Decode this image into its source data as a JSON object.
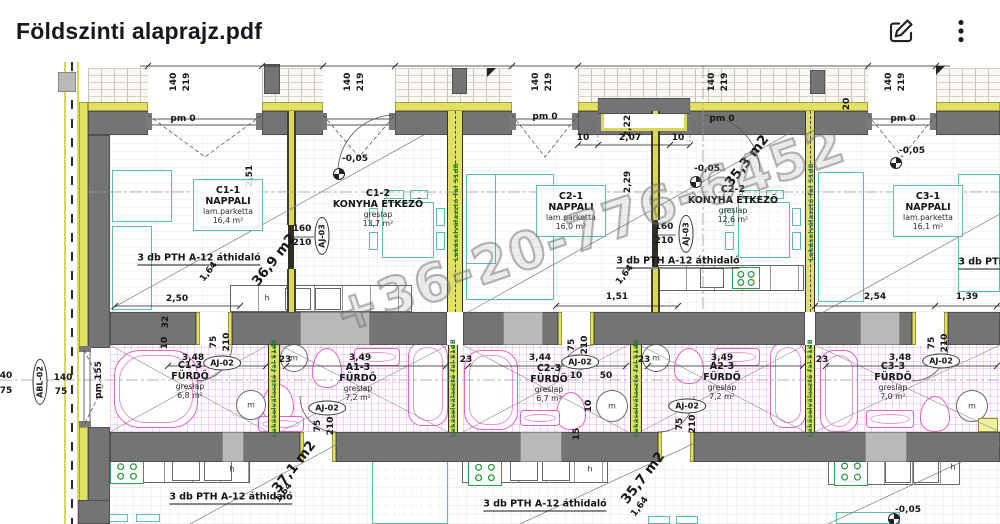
{
  "header": {
    "title": "Földszinti alaprajz.pdf"
  },
  "plan": {
    "watermark": "+36-20-776-6452",
    "separator_wall_label": "Lakáselválasztó fal 51dB",
    "lintel_label": "3 db PTH A-12 áthidaló",
    "separator_positions": [
      {
        "x": 456,
        "y": 150
      },
      {
        "x": 811,
        "y": 150
      },
      {
        "x": 274,
        "y": 326
      },
      {
        "x": 453,
        "y": 326
      },
      {
        "x": 636,
        "y": 326
      },
      {
        "x": 810,
        "y": 326
      }
    ],
    "lintel_positions": [
      {
        "x": 199,
        "y": 197
      },
      {
        "x": 678,
        "y": 200
      },
      {
        "x": 231,
        "y": 436
      },
      {
        "x": 545,
        "y": 443
      },
      {
        "x": 1020,
        "y": 201
      }
    ],
    "rooms": [
      {
        "id": "C1-1",
        "name": "NAPPALI",
        "floor": "lam.parketta",
        "area": "16,4 m²",
        "x": 228,
        "y": 117,
        "boxed": true
      },
      {
        "id": "C1-2",
        "name": "KONYHA ÉTKEZŐ",
        "floor": "greslap",
        "area": "13,7 m²",
        "x": 378,
        "y": 126
      },
      {
        "id": "C2-1",
        "name": "NAPPALI",
        "floor": "lam.parketta",
        "area": "16,0 m²",
        "x": 571,
        "y": 123,
        "boxed": true
      },
      {
        "id": "C2-2",
        "name": "KONYHA ÉTKEZŐ",
        "floor": "greslap",
        "area": "12,6 m²",
        "x": 733,
        "y": 122
      },
      {
        "id": "C3-1",
        "name": "NAPPALI",
        "floor": "lam.parketta",
        "area": "16,1 m²",
        "x": 928,
        "y": 123,
        "boxed": true
      },
      {
        "id": "C1-3",
        "name": "FÜRDŐ",
        "floor": "greslap",
        "area": "6,8 m²",
        "x": 190,
        "y": 298
      },
      {
        "id": "A1-3",
        "name": "FÜRDŐ",
        "floor": "greslap",
        "area": "7,2 m²",
        "x": 358,
        "y": 300
      },
      {
        "id": "C2-3",
        "name": "FÜRDŐ",
        "floor": "greslap",
        "area": "6,7 m²",
        "x": 549,
        "y": 301
      },
      {
        "id": "A2-3",
        "name": "FÜRDŐ",
        "floor": "greslap",
        "area": "7,2 m²",
        "x": 722,
        "y": 299
      },
      {
        "id": "C3-3",
        "name": "FÜRDŐ",
        "floor": "greslap",
        "area": "7,0 m²",
        "x": 893,
        "y": 299
      }
    ],
    "levels": [
      {
        "x": 338,
        "y": 111
      },
      {
        "x": 695,
        "y": 119
      },
      {
        "x": 895,
        "y": 100
      },
      {
        "x": 893,
        "y": 456
      }
    ],
    "annotations": [
      {
        "t": "140",
        "x": 174,
        "y": 20,
        "r": -90
      },
      {
        "t": "219",
        "x": 187,
        "y": 20,
        "r": -90
      },
      {
        "t": "140",
        "x": 348,
        "y": 20,
        "r": -90
      },
      {
        "t": "219",
        "x": 361,
        "y": 20,
        "r": -90
      },
      {
        "t": "140",
        "x": 536,
        "y": 20,
        "r": -90
      },
      {
        "t": "219",
        "x": 549,
        "y": 20,
        "r": -90
      },
      {
        "t": "140",
        "x": 712,
        "y": 20,
        "r": -90
      },
      {
        "t": "219",
        "x": 725,
        "y": 20,
        "r": -90
      },
      {
        "t": "140",
        "x": 889,
        "y": 20,
        "r": -90
      },
      {
        "t": "219",
        "x": 902,
        "y": 20,
        "r": -90
      },
      {
        "t": "pm 0",
        "x": 183,
        "y": 57,
        "c": "pm"
      },
      {
        "t": "pm 0",
        "x": 545,
        "y": 55,
        "c": "pm"
      },
      {
        "t": "pm 0",
        "x": 722,
        "y": 57,
        "c": "pm"
      },
      {
        "t": "pm 0",
        "x": 903,
        "y": 57,
        "c": "pm"
      },
      {
        "t": "pm 155",
        "x": 99,
        "y": 318,
        "r": -90,
        "c": "pm"
      },
      {
        "t": "-0,05",
        "x": 355,
        "y": 97
      },
      {
        "t": "-0,05",
        "x": 707,
        "y": 107
      },
      {
        "t": "-0,05",
        "x": 912,
        "y": 89
      },
      {
        "t": "-0,05",
        "x": 908,
        "y": 448
      },
      {
        "t": "2,51",
        "x": 250,
        "y": 114,
        "r": -90
      },
      {
        "t": "2,29",
        "x": 628,
        "y": 120,
        "r": -90
      },
      {
        "t": "2,22",
        "x": 628,
        "y": 64,
        "r": -90
      },
      {
        "t": "20",
        "x": 847,
        "y": 42,
        "r": -90
      },
      {
        "t": "32",
        "x": 166,
        "y": 260,
        "r": -90
      },
      {
        "t": "10",
        "x": 165,
        "y": 281,
        "r": -90
      },
      {
        "t": "10",
        "x": 583,
        "y": 76
      },
      {
        "t": "2,07",
        "x": 630,
        "y": 76
      },
      {
        "t": "10",
        "x": 678,
        "y": 76
      },
      {
        "t": "2,50",
        "x": 177,
        "y": 237
      },
      {
        "t": "1,51",
        "x": 617,
        "y": 235
      },
      {
        "t": "2,54",
        "x": 875,
        "y": 235
      },
      {
        "t": "1,39",
        "x": 967,
        "y": 235
      },
      {
        "t": "3,48",
        "x": 193,
        "y": 296
      },
      {
        "t": "3,49",
        "x": 360,
        "y": 296
      },
      {
        "t": "3,44",
        "x": 540,
        "y": 296
      },
      {
        "t": "3,49",
        "x": 722,
        "y": 296
      },
      {
        "t": "3,48",
        "x": 900,
        "y": 296
      },
      {
        "t": "23",
        "x": 285,
        "y": 298
      },
      {
        "t": "23",
        "x": 466,
        "y": 298
      },
      {
        "t": "23",
        "x": 644,
        "y": 298
      },
      {
        "t": "23",
        "x": 822,
        "y": 298
      },
      {
        "t": "10",
        "x": 576,
        "y": 314
      },
      {
        "t": "50",
        "x": 606,
        "y": 314
      },
      {
        "t": "10",
        "x": 589,
        "y": 344,
        "r": -90
      },
      {
        "t": "15",
        "x": 577,
        "y": 372,
        "r": -90
      },
      {
        "t": "40",
        "x": 6,
        "y": 314
      },
      {
        "t": "75",
        "x": 6,
        "y": 329
      },
      {
        "t": "140",
        "x": 63,
        "y": 316
      },
      {
        "t": "75",
        "x": 61,
        "y": 330
      },
      {
        "t": "75",
        "x": 214,
        "y": 280,
        "r": -90
      },
      {
        "t": "210",
        "x": 227,
        "y": 280,
        "r": -90
      },
      {
        "t": "75",
        "x": 318,
        "y": 364,
        "r": -90
      },
      {
        "t": "210",
        "x": 331,
        "y": 364,
        "r": -90
      },
      {
        "t": "75",
        "x": 572,
        "y": 283,
        "r": -90
      },
      {
        "t": "210",
        "x": 585,
        "y": 283,
        "r": -90
      },
      {
        "t": "75",
        "x": 680,
        "y": 362,
        "r": -90
      },
      {
        "t": "210",
        "x": 693,
        "y": 362,
        "r": -90
      },
      {
        "t": "75",
        "x": 932,
        "y": 281,
        "r": -90
      },
      {
        "t": "210",
        "x": 945,
        "y": 281,
        "r": -90
      },
      {
        "t": "160",
        "x": 302,
        "y": 167
      },
      {
        "t": "210",
        "x": 302,
        "y": 181
      },
      {
        "t": "160",
        "x": 664,
        "y": 165
      },
      {
        "t": "210",
        "x": 664,
        "y": 179
      },
      {
        "t": "1,64",
        "x": 209,
        "y": 210,
        "r": -52
      },
      {
        "t": "1,64",
        "x": 625,
        "y": 213,
        "r": -52
      },
      {
        "t": "1,64",
        "x": 284,
        "y": 431,
        "r": -52
      },
      {
        "t": "1,64",
        "x": 640,
        "y": 445,
        "r": -52
      },
      {
        "t": "36,9 m2",
        "x": 274,
        "y": 198,
        "r": -52,
        "c": "big"
      },
      {
        "t": "35,3 m2",
        "x": 747,
        "y": 99,
        "r": -52,
        "c": "big"
      },
      {
        "t": "37,1 m2",
        "x": 294,
        "y": 405,
        "r": -52,
        "c": "big"
      },
      {
        "t": "35,7 m2",
        "x": 643,
        "y": 416,
        "r": -52,
        "c": "big"
      },
      {
        "t": "AJ-03",
        "x": 322,
        "y": 174,
        "r": -90,
        "c": "tag"
      },
      {
        "t": "AJ-03",
        "x": 686,
        "y": 172,
        "r": -90,
        "c": "tag"
      },
      {
        "t": "AJ-02",
        "x": 222,
        "y": 301,
        "c": "tag"
      },
      {
        "t": "AJ-02",
        "x": 327,
        "y": 346,
        "c": "tag"
      },
      {
        "t": "AJ-02",
        "x": 580,
        "y": 300,
        "c": "tag"
      },
      {
        "t": "AJ-02",
        "x": 687,
        "y": 344,
        "c": "tag"
      },
      {
        "t": "AJ-02",
        "x": 941,
        "y": 299,
        "c": "tag"
      },
      {
        "t": "ABL-02",
        "x": 40,
        "y": 320,
        "r": -90,
        "c": "tag"
      },
      {
        "t": "m",
        "x": 251,
        "y": 343,
        "c": "m"
      },
      {
        "t": "m",
        "x": 294,
        "y": 296,
        "c": "m"
      },
      {
        "t": "m",
        "x": 612,
        "y": 344,
        "c": "m"
      },
      {
        "t": "m",
        "x": 656,
        "y": 296,
        "c": "m"
      },
      {
        "t": "m",
        "x": 972,
        "y": 344,
        "c": "m"
      },
      {
        "t": "h",
        "x": 267,
        "y": 236,
        "c": "h"
      },
      {
        "t": "h",
        "x": 232,
        "y": 407,
        "c": "h"
      },
      {
        "t": "h",
        "x": 590,
        "y": 407,
        "c": "h"
      },
      {
        "t": "h",
        "x": 953,
        "y": 405,
        "c": "h"
      }
    ]
  }
}
